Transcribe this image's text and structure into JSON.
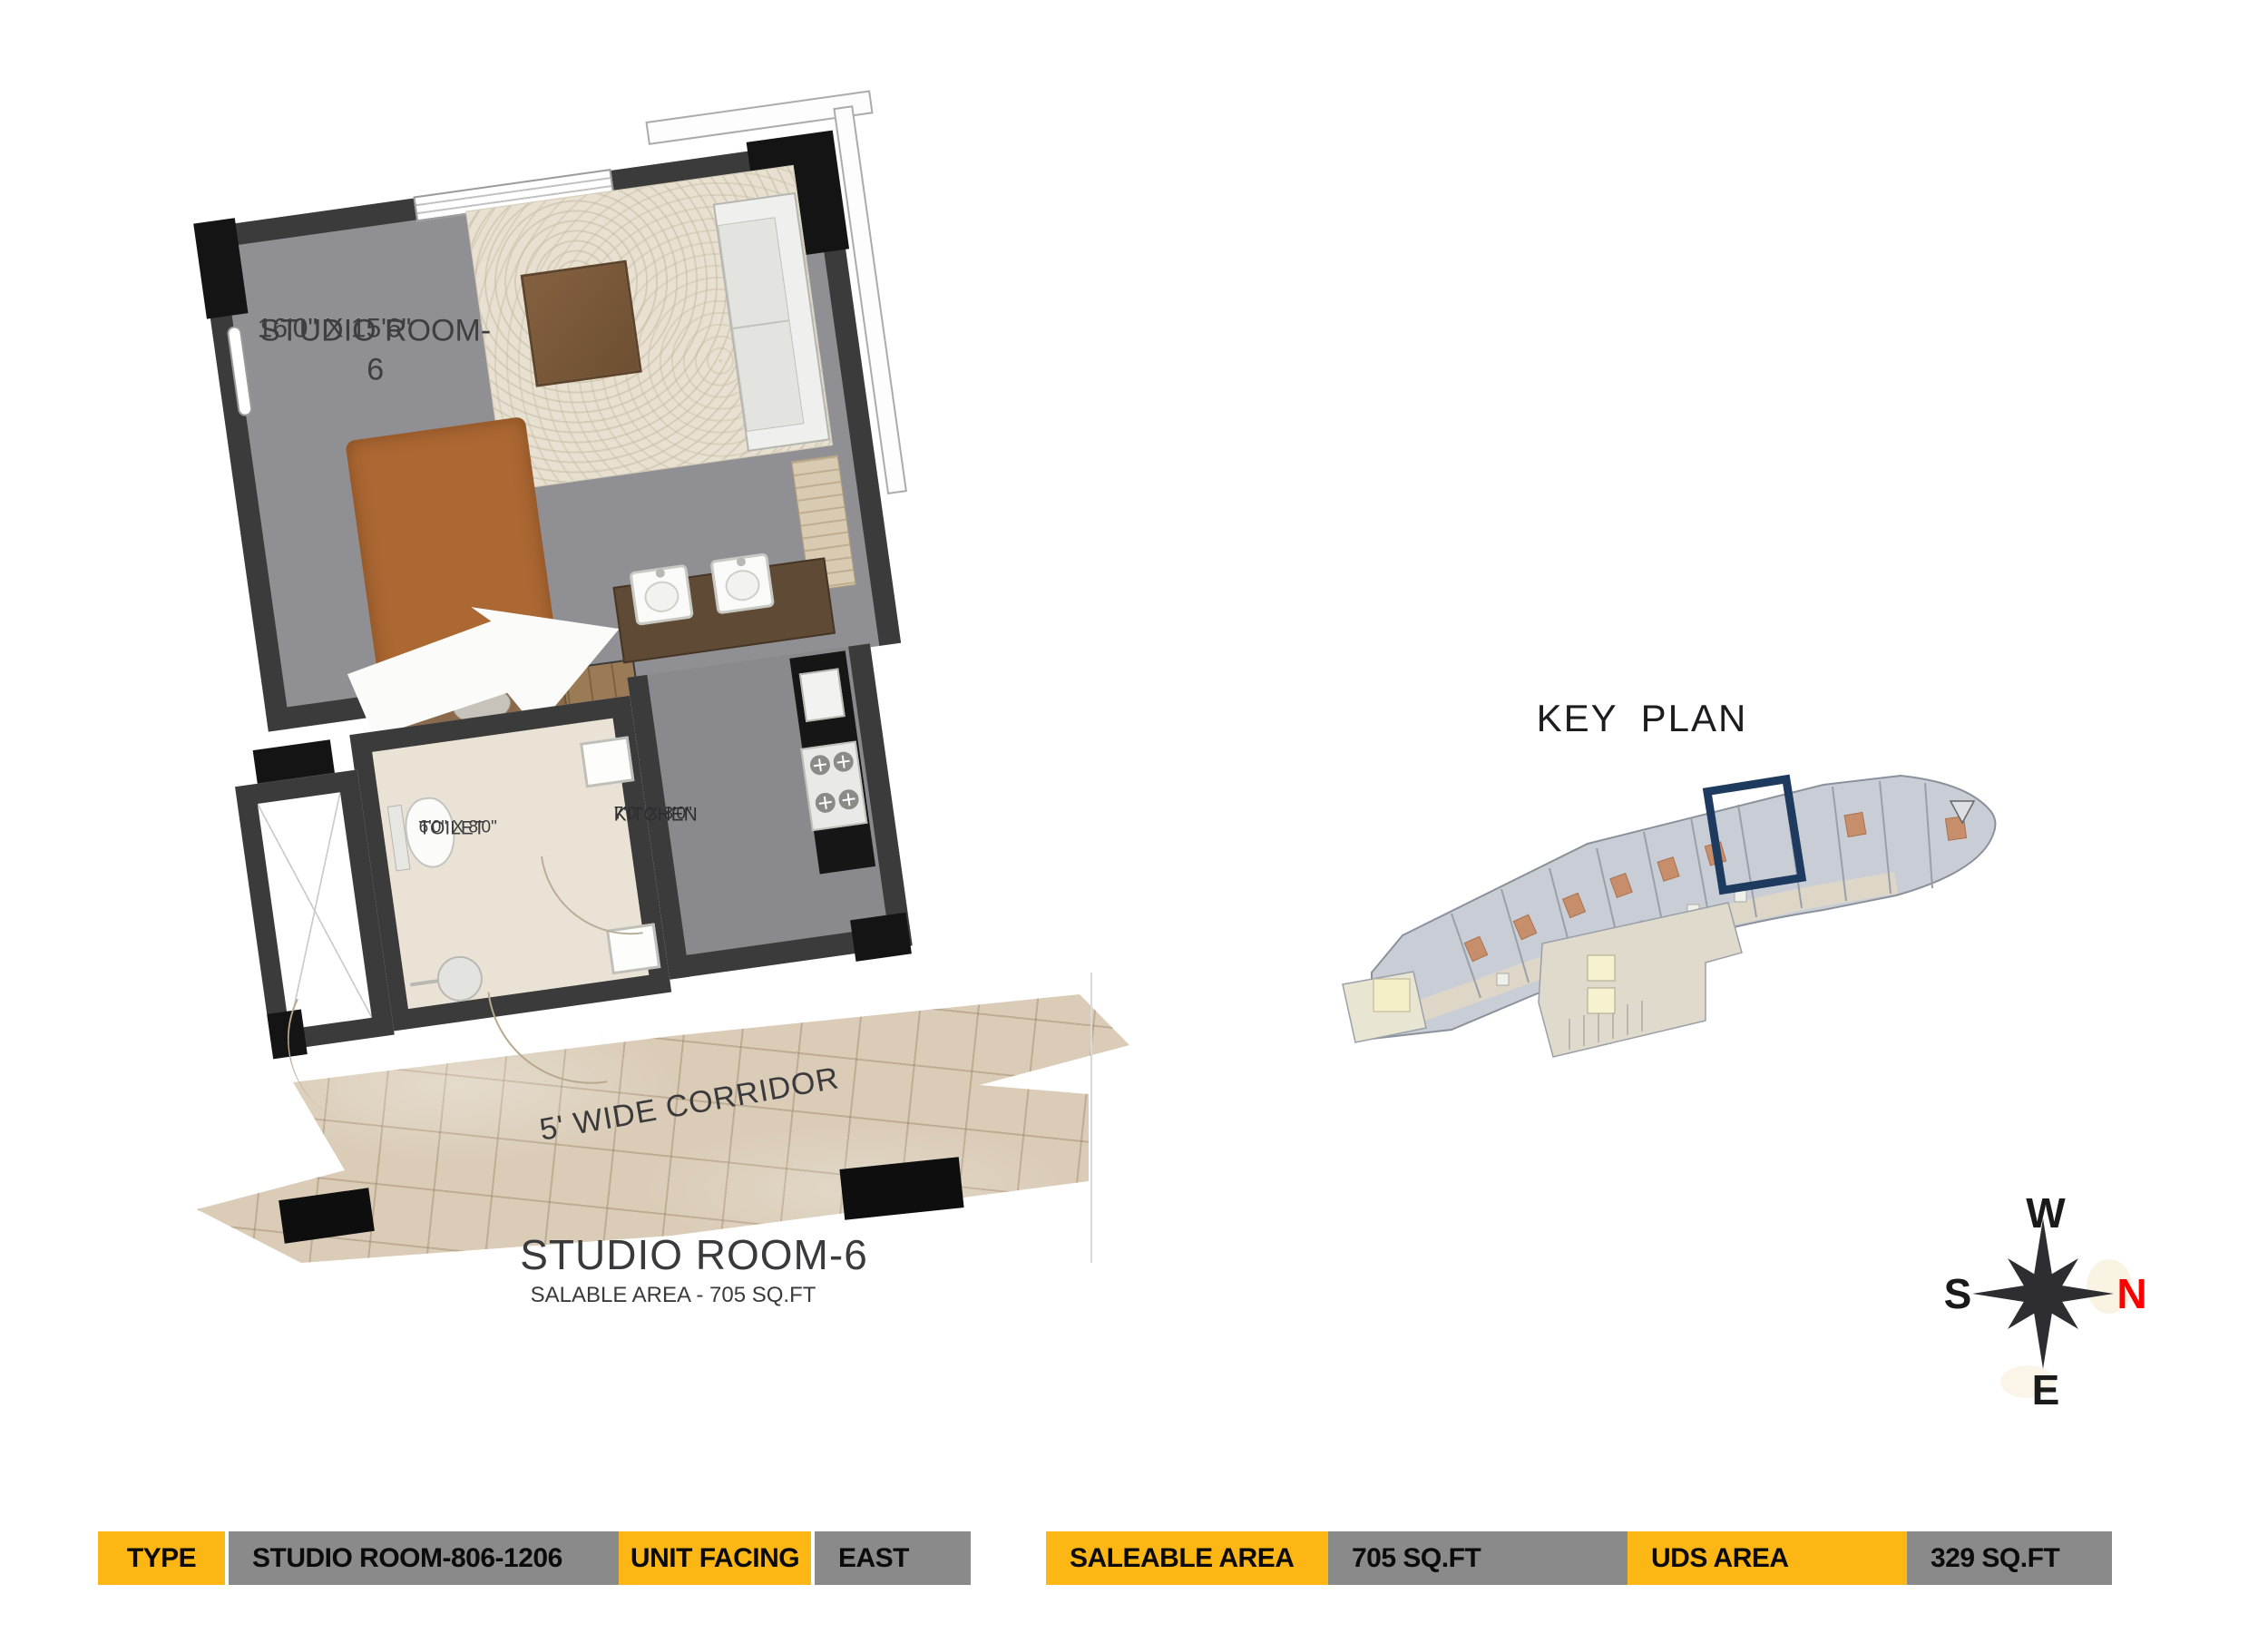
{
  "floor_plan": {
    "room_name": "STUDIO ROOM-6",
    "room_dims": "16'0\" X 15'6\"",
    "toilet_name": "TOILET",
    "toilet_dims": "6'0\" X 8'0\"",
    "kitchen_name": "KITCHEN",
    "kitchen_dims": "7'0\" X 8'0\"",
    "corridor_label": "5' WIDE CORRIDOR",
    "caption_title": "STUDIO ROOM-6",
    "caption_subtitle": "SALABLE AREA - 705 SQ.FT"
  },
  "key_plan": {
    "title": "KEY PLAN",
    "highlight_color": "#1E3A5F"
  },
  "compass": {
    "west": "W",
    "south": "S",
    "north": "N",
    "east": "E",
    "north_color": "#FF0000"
  },
  "info_bar": {
    "cells": [
      {
        "label": "TYPE",
        "value": "STUDIO ROOM-806-1206"
      },
      {
        "label": "UNIT FACING",
        "value": "EAST"
      },
      {
        "label": "SALEABLE AREA",
        "value": "705 SQ.FT"
      },
      {
        "label": "UDS AREA",
        "value": "329 SQ.FT"
      }
    ],
    "label_bg": "#FDB714",
    "value_bg": "#8A8A8A"
  },
  "colors": {
    "wall": "#3B3B3C",
    "floor_main": "#908F94",
    "floor_kitchen": "#8A898E",
    "floor_toilet": "#EAE2D4",
    "rug": "#E8E1D1",
    "bed": "#AC6833",
    "corridor": "#DACCB7",
    "counter_dark": "#161616",
    "vanity": "#5F4A35"
  }
}
